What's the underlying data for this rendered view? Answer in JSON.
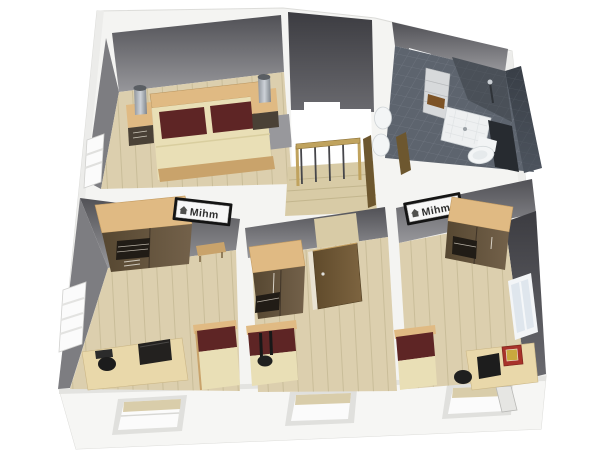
{
  "scene": {
    "type": "3d-floorplan-render",
    "view": "top-down-perspective",
    "brand": {
      "label": "Mihm",
      "icon": "house"
    }
  },
  "rooms": [
    {
      "name": "bedroom",
      "position": "top-left",
      "furniture": [
        "double-bed",
        "maroon-pillows",
        "nightstand-left",
        "table-lamp-left",
        "nightstand-right",
        "table-lamp-right",
        "gray-floor-mat",
        "window-west"
      ]
    },
    {
      "name": "stair-hall",
      "position": "top-center",
      "furniture": [
        "stair-opening",
        "wood-railing",
        "steps",
        "open-door"
      ]
    },
    {
      "name": "bathroom",
      "position": "top-right",
      "furniture": [
        "window-north",
        "shelf-with-towel",
        "shower-tray",
        "shower-fixture",
        "toilet",
        "washbasin-1",
        "washbasin-2",
        "open-door"
      ]
    },
    {
      "name": "room-bottom-left",
      "position": "bottom-left",
      "furniture": [
        "wardrobe",
        "wall-sign-mihm",
        "wall-shelf",
        "window-west",
        "desk",
        "office-chair",
        "printer",
        "bed"
      ]
    },
    {
      "name": "room-bottom-middle",
      "position": "bottom-center",
      "furniture": [
        "wardrobe",
        "open-door",
        "bed",
        "chair"
      ]
    },
    {
      "name": "room-bottom-right",
      "position": "bottom-right",
      "furniture": [
        "wall-sign-mihm",
        "wardrobe",
        "window-east",
        "bed",
        "desk",
        "monitor",
        "red-case",
        "office-chair"
      ]
    }
  ],
  "exterior": {
    "wall_color": "white",
    "windows_bottom_count": 3
  },
  "colors": {
    "bg": "#ffffff",
    "shell": "#f4f4f2",
    "shell-shade": "#e3e3e0",
    "wall-face": "#7d7d81",
    "floor": "#dccfae",
    "floor-line": "#c3b691",
    "floor-stairs": "#d8cba6",
    "bath-floor": "#5d646e",
    "bath-grout": "#7e8590",
    "tile-dark": "#3f454e",
    "duvet": "#e9dfb6",
    "pillow": "#5e2525",
    "wood-light": "#e0ba83",
    "wood-mid": "#c9a36b",
    "wood-dark": "#63523a",
    "door": "#6d572f",
    "desk": "#e9d8aa",
    "chair": "#1c1c1c",
    "red-box": "#a8322a",
    "red-box-gold": "#c9a83e",
    "lamp": "#b7bcc2",
    "railing": "#c0a35e",
    "sign-bg": "#f7f7f7",
    "sign-frame": "#141414",
    "sign-text": "#2e2e2e",
    "fixture-white": "#f2f4f5",
    "shelf-gray": "#d7d9db",
    "towel": "#7d5326",
    "window-white": "#fbfbfb"
  }
}
